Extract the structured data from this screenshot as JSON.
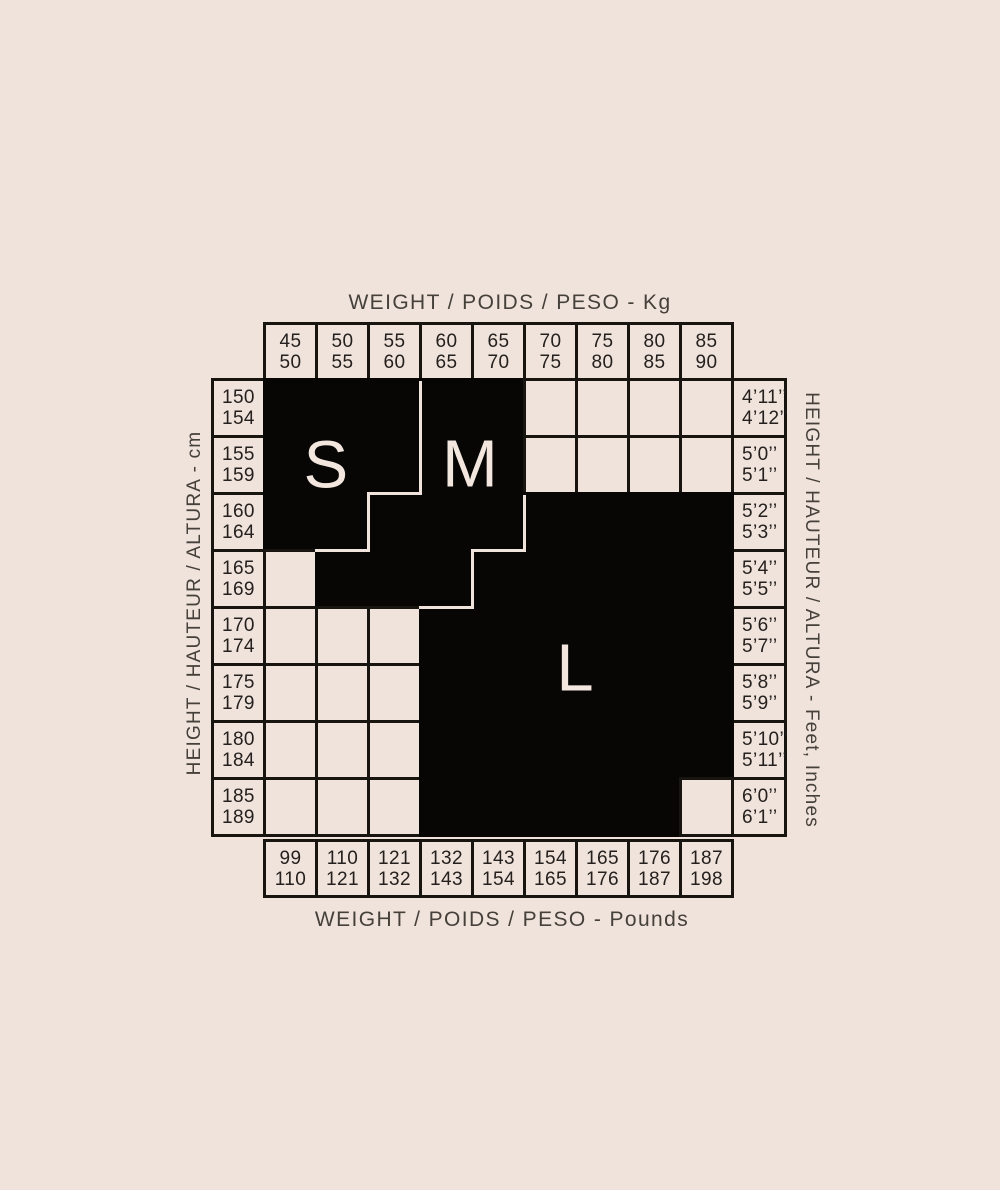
{
  "colors": {
    "background": "#efe3dc",
    "block_fill": "#070605",
    "grid_line": "#18140f",
    "axis_label_color": "#46403a",
    "number_color": "#25201d",
    "letter_color": "#f2e6de"
  },
  "axes": {
    "top": "WEIGHT / POIDS / PESO - Kg",
    "bottom": "WEIGHT / POIDS / PESO - Pounds",
    "left": "HEIGHT / HAUTEUR / ALTURA - cm",
    "right": "HEIGHT / HAUTEUR / ALTURA - Feet, Inches"
  },
  "chart_data": {
    "type": "table",
    "title": "Size chart (S / M / L) by height and weight",
    "weight_kg_columns": [
      [
        "45",
        "50"
      ],
      [
        "50",
        "55"
      ],
      [
        "55",
        "60"
      ],
      [
        "60",
        "65"
      ],
      [
        "65",
        "70"
      ],
      [
        "70",
        "75"
      ],
      [
        "75",
        "80"
      ],
      [
        "80",
        "85"
      ],
      [
        "85",
        "90"
      ]
    ],
    "weight_lb_columns": [
      [
        "99",
        "110"
      ],
      [
        "110",
        "121"
      ],
      [
        "121",
        "132"
      ],
      [
        "132",
        "143"
      ],
      [
        "143",
        "154"
      ],
      [
        "154",
        "165"
      ],
      [
        "165",
        "176"
      ],
      [
        "176",
        "187"
      ],
      [
        "187",
        "198"
      ]
    ],
    "height_cm_rows": [
      [
        "150",
        "154"
      ],
      [
        "155",
        "159"
      ],
      [
        "160",
        "164"
      ],
      [
        "165",
        "169"
      ],
      [
        "170",
        "174"
      ],
      [
        "175",
        "179"
      ],
      [
        "180",
        "184"
      ],
      [
        "185",
        "189"
      ]
    ],
    "height_ft_rows": [
      [
        "4’11’’",
        "4’12’’"
      ],
      [
        "5’0’’",
        "5’1’’"
      ],
      [
        "5’2’’",
        "5’3’’"
      ],
      [
        "5’4’’",
        "5’5’’"
      ],
      [
        "5’6’’",
        "5’7’’"
      ],
      [
        "5’8’’",
        "5’9’’"
      ],
      [
        "5’10’’",
        "5’11’’"
      ],
      [
        "6’0’’",
        "6’1’’"
      ]
    ],
    "size_map": [
      "SSSMM----",
      "SSSMM----",
      "SSMMMLLLL",
      "-MMMLLLLL",
      "---LLLLLL",
      "---LLLLLL",
      "---LLLLLL",
      "---LLLLL-"
    ],
    "sizes": [
      {
        "label": "S",
        "col": 1.21,
        "row": 1.53
      },
      {
        "label": "M",
        "col": 3.98,
        "row": 1.5
      },
      {
        "label": "L",
        "col": 6.0,
        "row": 5.08
      }
    ]
  }
}
